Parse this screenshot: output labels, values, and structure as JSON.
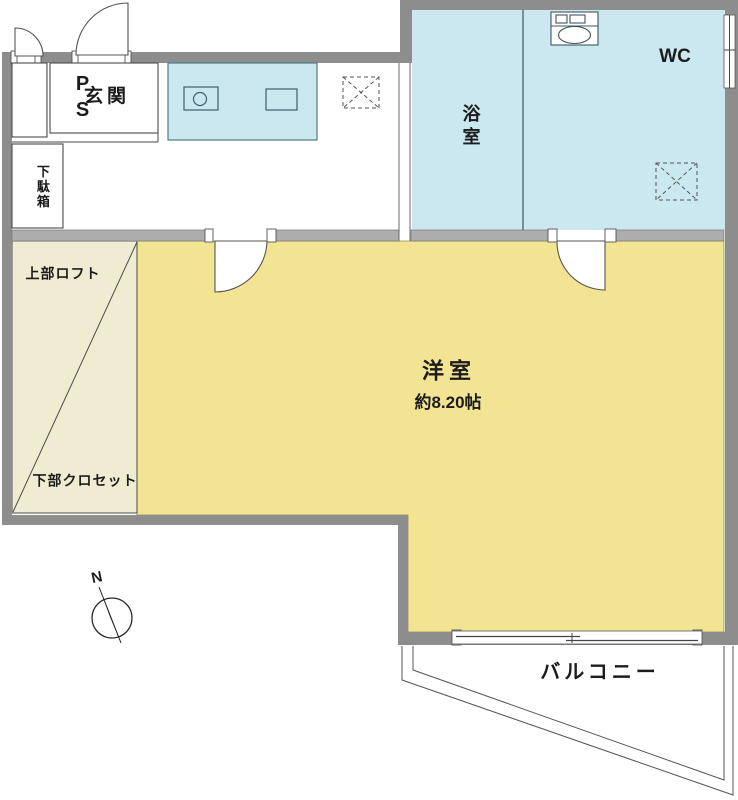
{
  "rooms": {
    "pipe_space": {
      "label": "PS"
    },
    "entrance": {
      "label": "玄関"
    },
    "shoe_cabinet": {
      "label": "下駄箱"
    },
    "bathroom": {
      "label": "浴室"
    },
    "wc": {
      "label": "WC"
    },
    "western_room": {
      "label": "洋室",
      "size": "約8.20帖"
    },
    "loft": {
      "label": "上部ロフト"
    },
    "closet": {
      "label": "下部クロセット"
    },
    "balcony": {
      "label": "バルコニー"
    }
  },
  "compass": {
    "north_label": "N"
  },
  "colors": {
    "wall_dark": "#8D8D8D",
    "wall_light": "#ADADAD",
    "room_yellow": "#F2E492",
    "loft_cream": "#F0ECD2",
    "water_blue": "#CBE7F0",
    "line_dark": "#4A4A4A"
  }
}
